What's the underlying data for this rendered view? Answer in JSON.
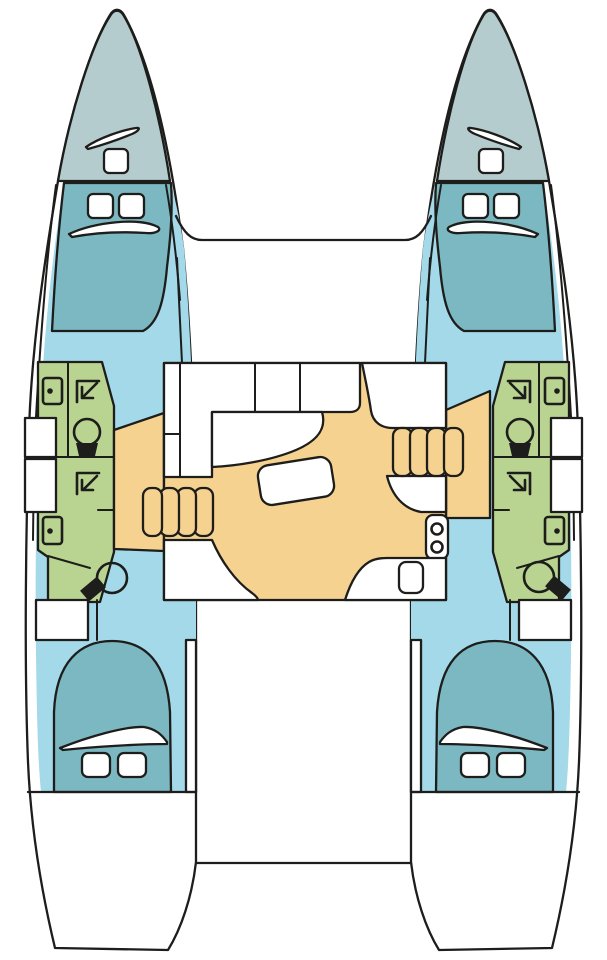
{
  "title": "Catamaran interior layout plan",
  "colors": {
    "outline": "#1d1d1b",
    "white": "#ffffff",
    "deck": "#b5cccf",
    "bed_teal": "#7cb8c2",
    "corridor_blue": "#a4d9e9",
    "bathroom_green": "#b9d391",
    "floor_yellow": "#f5d28f",
    "fixture_black": "#1d1d1b"
  },
  "rooms": {
    "port": {
      "label": "Port hull"
    },
    "starboard": {
      "label": "Starboard hull"
    },
    "foredeck": {
      "label": "Foredeck bow with deck hatch"
    },
    "forward_cabin": {
      "label": "Forward double cabin with two hatches"
    },
    "bathroom_forward": {
      "label": "Forward bathroom with washbasin, shower and toilet"
    },
    "bathroom_aft": {
      "label": "Aft bathroom with washbasin, shower and toilet"
    },
    "stairs": {
      "label": "Companionway steps",
      "steps": 4
    },
    "aft_cabin": {
      "label": "Aft double cabin with two hatches"
    },
    "salon": {
      "label": "Salon with settee, table, chart seat, galley sink and stove"
    },
    "galley_sink": {
      "label": "Galley double sink",
      "basins": 2
    },
    "cockpit": {
      "label": "Cockpit and aft platform"
    }
  }
}
